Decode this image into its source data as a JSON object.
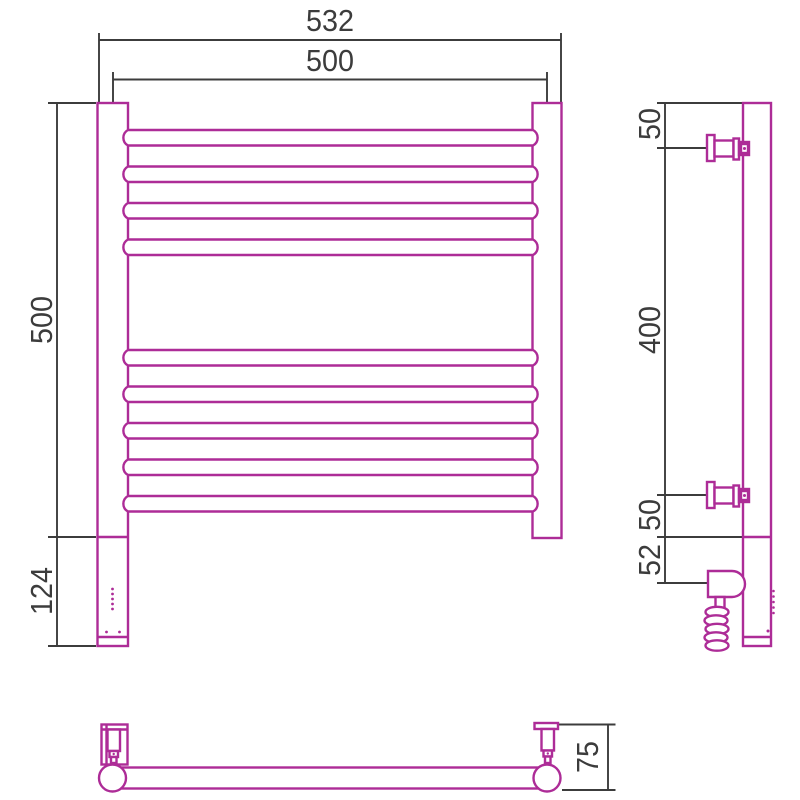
{
  "drawing_type": "technical drawing — heated towel rail (three orthographic views)",
  "colors": {
    "outline": "#ad2c97",
    "dimension": "#3c3c3c",
    "background": "#ffffff"
  },
  "dims": {
    "front": {
      "overall_width": "532",
      "rail_length": "500",
      "height": "500",
      "heater_section": "124"
    },
    "side": {
      "top_to_bracket": "50",
      "bracket_to_bracket": "400",
      "bracket_to_bottom": "50",
      "bottom_to_heater": "52"
    },
    "plan": {
      "wall_offset": "75"
    }
  },
  "features": {
    "rail_count": 9,
    "rail_groups": [
      4,
      5
    ],
    "wall_brackets": 2,
    "has_heating_element": true,
    "has_coiled_cable": true
  }
}
